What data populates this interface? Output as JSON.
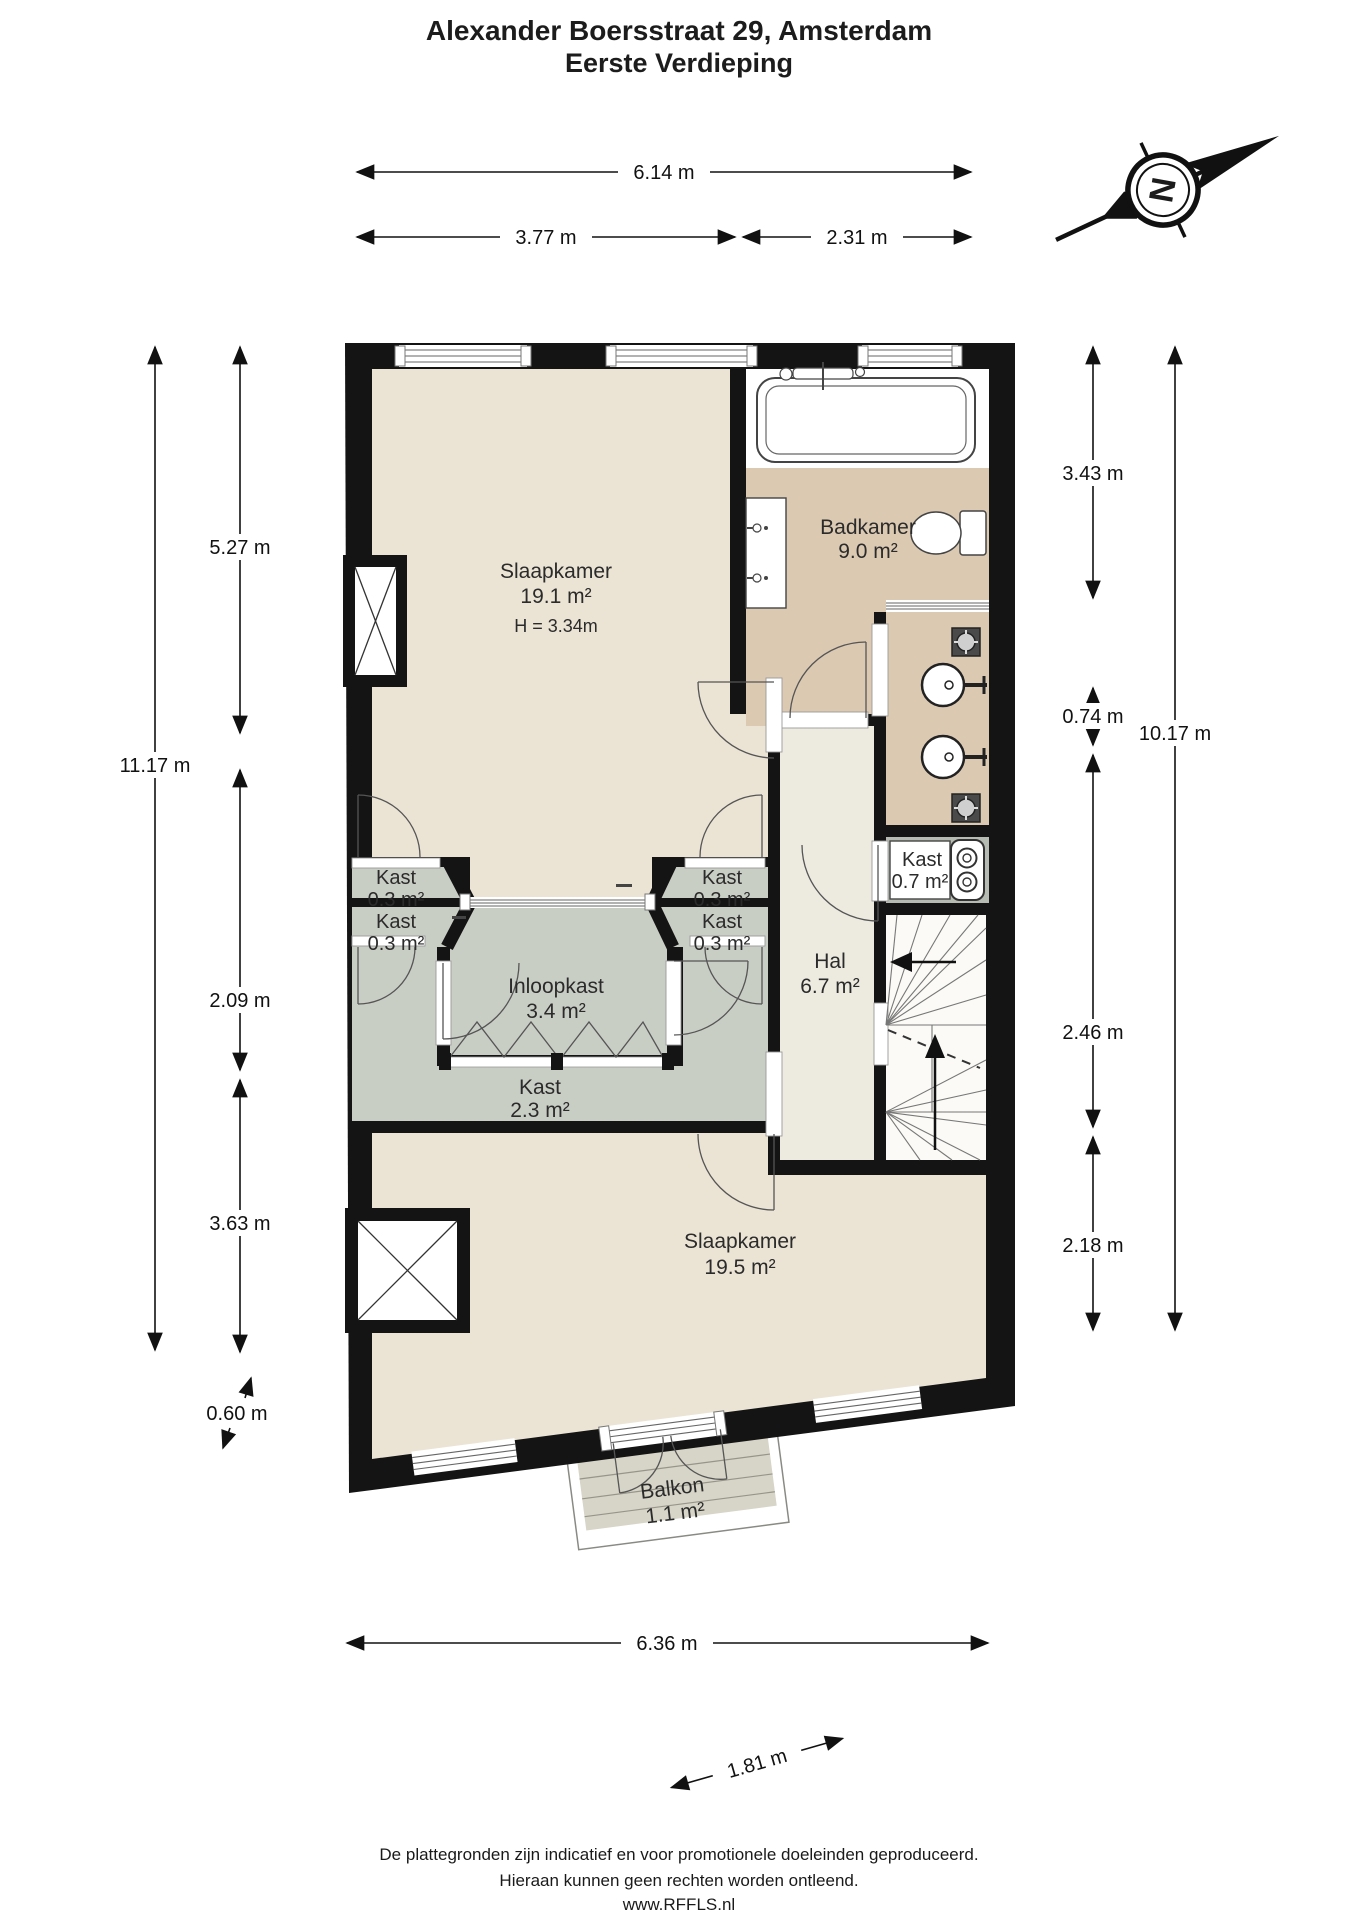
{
  "title": {
    "line1": "Alexander Boersstraat 29, Amsterdam",
    "line2": "Eerste Verdieping"
  },
  "compass": {
    "north_label": "N"
  },
  "rooms": {
    "slaapkamer1": {
      "name": "Slaapkamer",
      "area": "19.1 m²",
      "height": "H = 3.34m"
    },
    "badkamer": {
      "name": "Badkamer",
      "area": "9.0 m²"
    },
    "kast_tl1": {
      "name": "Kast",
      "area": "0.3 m²"
    },
    "kast_tl2": {
      "name": "Kast",
      "area": "0.3 m²"
    },
    "kast_tr1": {
      "name": "Kast",
      "area": "0.3 m²"
    },
    "kast_tr2": {
      "name": "Kast",
      "area": "0.3 m²"
    },
    "inloopkast": {
      "name": "Inloopkast",
      "area": "3.4 m²"
    },
    "kast23": {
      "name": "Kast",
      "area": "2.3 m²"
    },
    "kast07": {
      "name": "Kast",
      "area": "0.7 m²"
    },
    "hal": {
      "name": "Hal",
      "area": "6.7 m²"
    },
    "slaapkamer2": {
      "name": "Slaapkamer",
      "area": "19.5 m²"
    },
    "balkon": {
      "name": "Balkon",
      "area": "1.1 m²"
    }
  },
  "dimensions": {
    "top_total": "6.14 m",
    "top_left": "3.77 m",
    "top_right": "2.31 m",
    "left_outer": "11.17 m",
    "left_seg1": "5.27 m",
    "left_seg2": "2.09 m",
    "left_seg3": "3.63 m",
    "left_balkon": "0.60 m",
    "right_seg1": "3.43 m",
    "right_seg2": "0.74 m",
    "right_outer": "10.17 m",
    "right_seg3": "2.46 m",
    "right_seg4": "2.18 m",
    "bottom_total": "6.36 m",
    "bottom_balkon": "1.81 m"
  },
  "footer": {
    "line1": "De plattegronden zijn indicatief en voor promotionele doeleinden geproduceerd.",
    "line2": "Hieraan kunnen geen rechten worden ontleend.",
    "line3": "www.RFFLS.nl"
  },
  "icons": {
    "compass": "compass-north-icon",
    "bathtub": "bathtub-icon",
    "toilet": "toilet-icon",
    "vanity": "vanity-sink-icon",
    "basin": "wall-basin-icon",
    "vent": "ceiling-spot-icon",
    "washer": "washer-icon",
    "stairs": "staircase-icon",
    "chimney": "chimney-shaft-icon"
  },
  "colors": {
    "wall": "#141414",
    "bedroom_floor": "#ebe4d5",
    "bathroom_floor": "#dbc9b2",
    "closet_floor": "#c9cec5",
    "hall_floor": "#edeae0",
    "stairs_floor": "#fbfaf6",
    "kast07_floor": "#b7bcb3",
    "balcony_floor": "#d7d4c8",
    "white_zone": "#ffffff"
  }
}
